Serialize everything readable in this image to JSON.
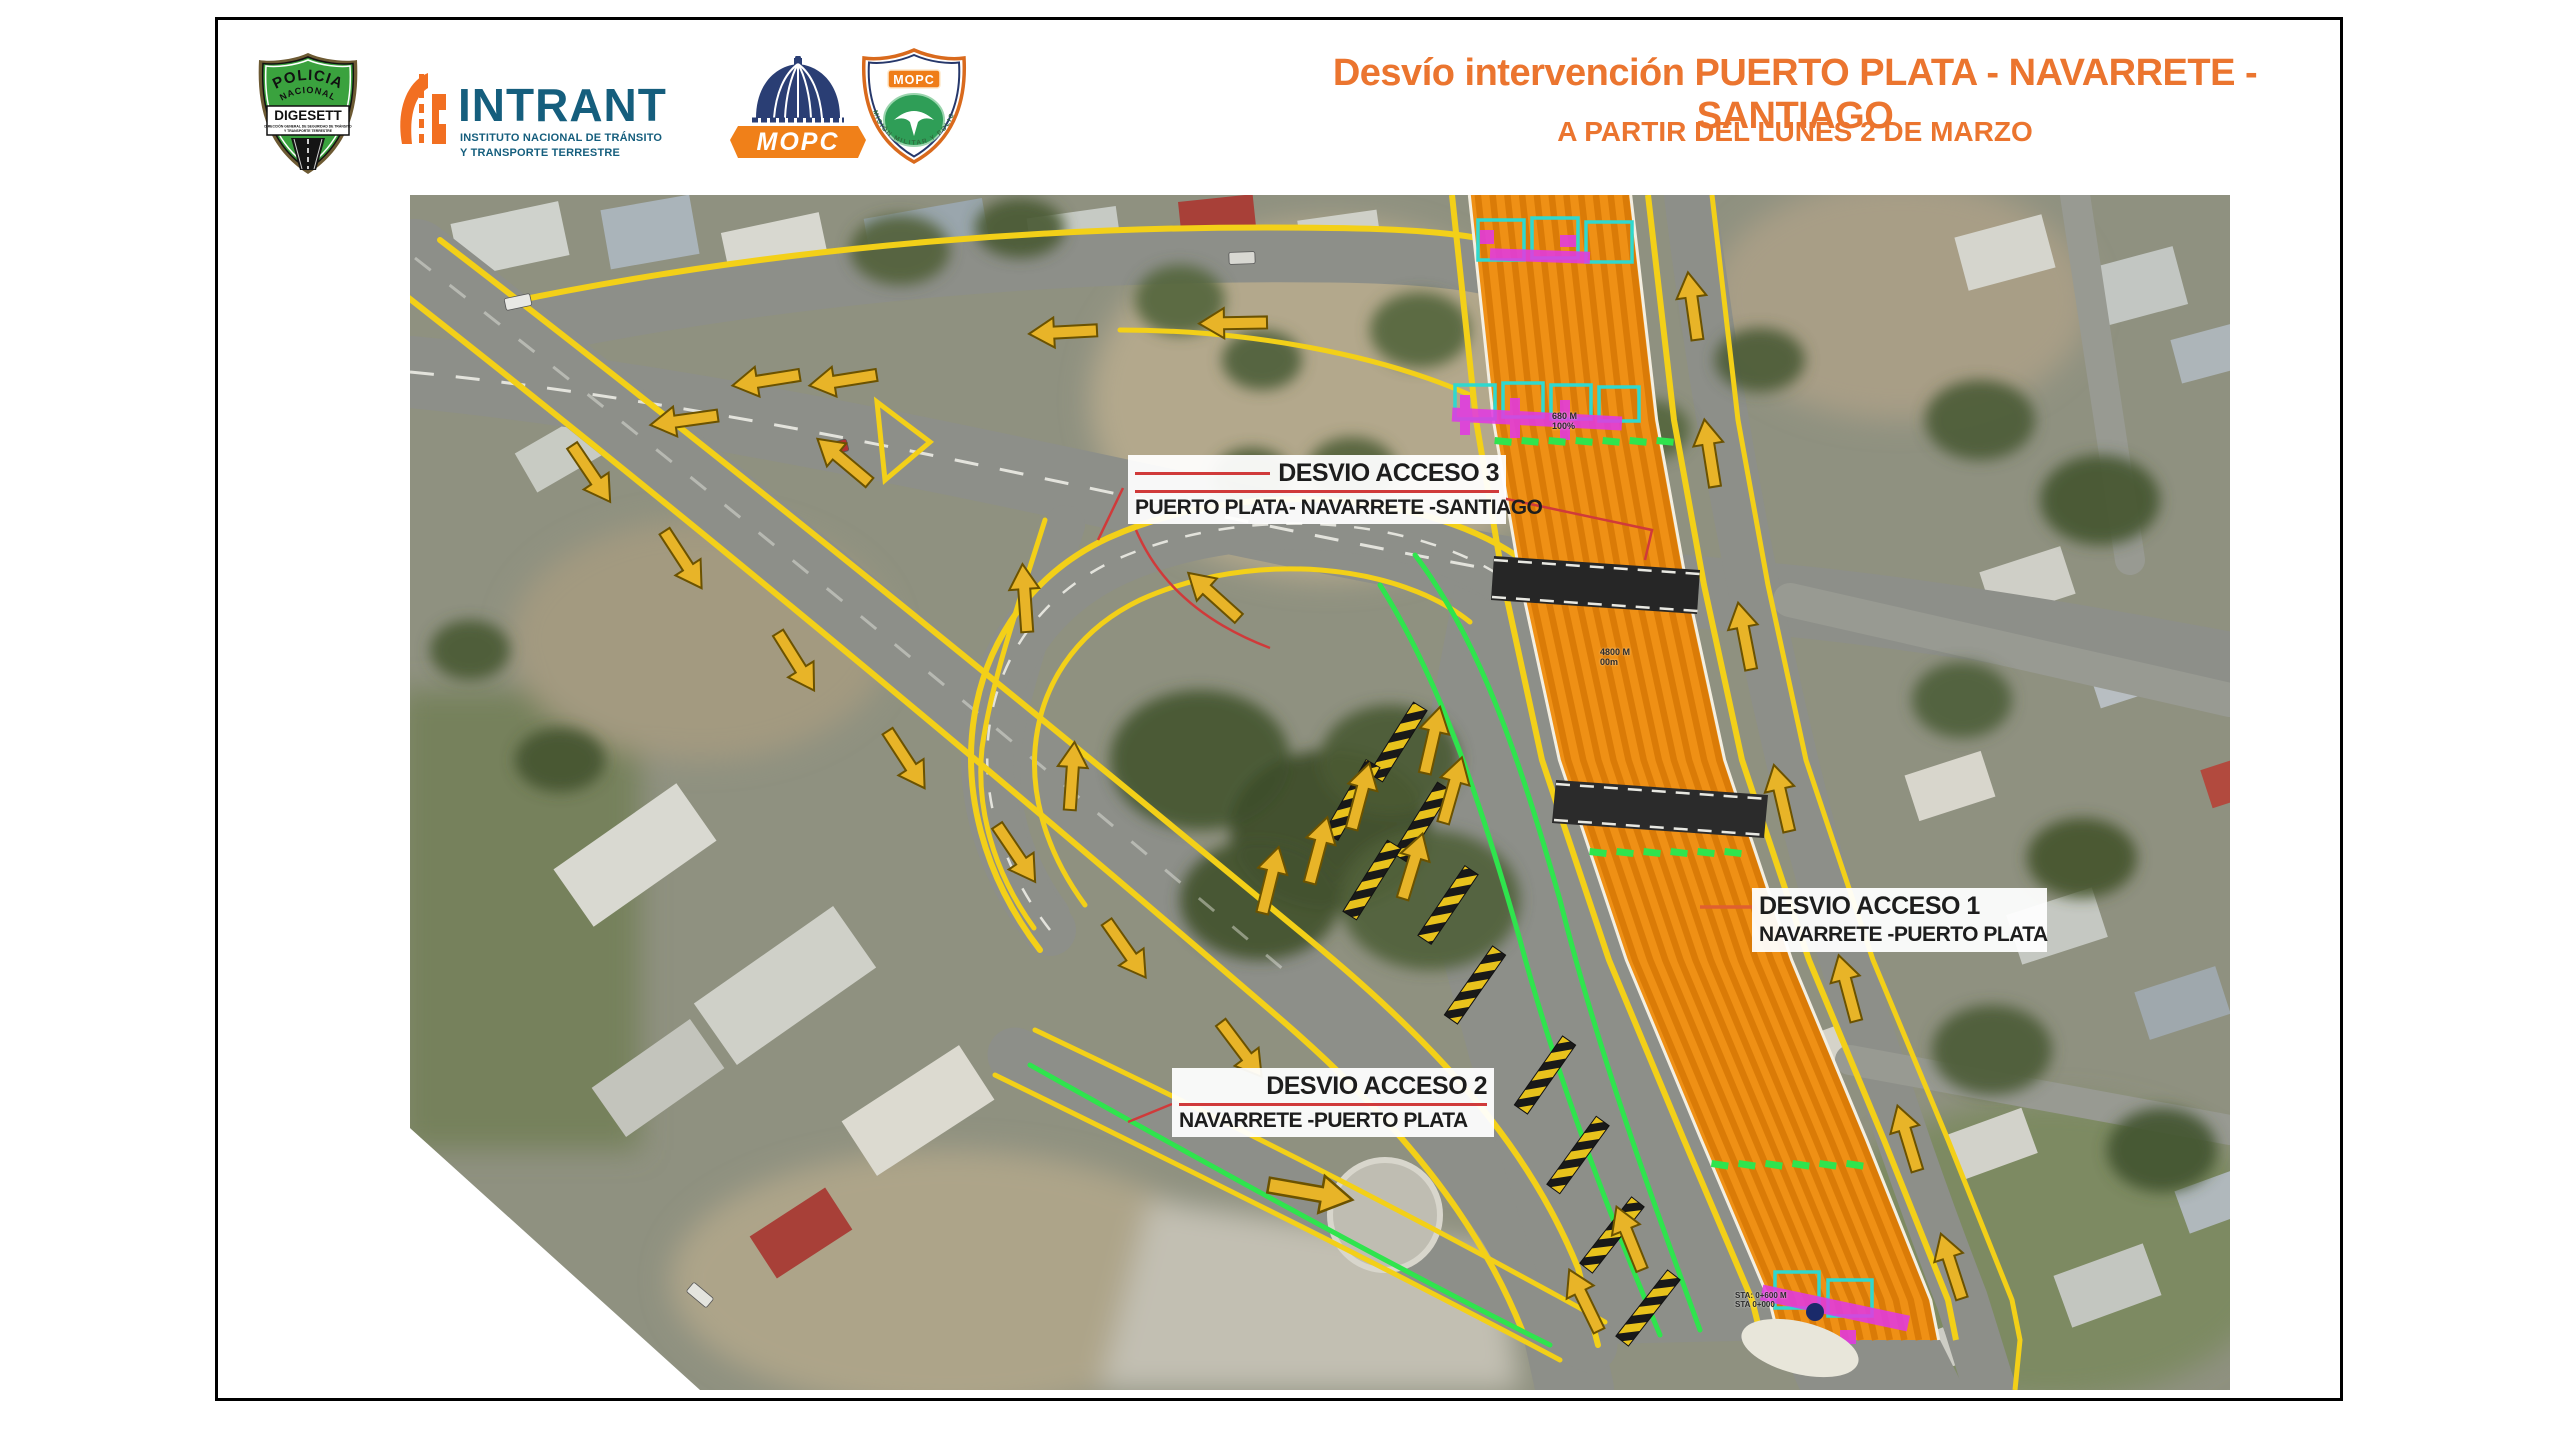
{
  "header": {
    "title": "Desvío intervención PUERTO PLATA - NAVARRETE - SANTIAGO",
    "subtitle": "A PARTIR DEL LUNES 2 DE MARZO",
    "accent_color": "#EB752F",
    "logos": {
      "digesett": {
        "arc_top": "POLICIA",
        "arc_mid": "NACIONAL",
        "band": "DIGESETT",
        "sub1": "DIRECCIÓN GENERAL DE SEGURIDAD DE TRÁNSITO",
        "sub2": "Y TRANSPORTE TERRESTRE"
      },
      "intrant": {
        "name": "INTRANT",
        "tagline1": "INSTITUTO NACIONAL DE TRÁNSITO",
        "tagline2": "Y TRANSPORTE TERRESTRE",
        "brand_color": "#155E7D",
        "icon_color": "#F26F21"
      },
      "mopc": {
        "name": "MOPC",
        "banner_color": "#F08019",
        "dome_color": "#2A3E74"
      },
      "mopc_shield": {
        "name": "MOPC",
        "ring_text": "COMISIÓN MILITAR Y POLICIAL"
      }
    }
  },
  "map": {
    "callouts": [
      {
        "id": "desvio-acceso-3",
        "line1": "DESVIO ACCESO 3",
        "line2": "PUERTO PLATA- NAVARRETE -SANTIAGO"
      },
      {
        "id": "desvio-acceso-1",
        "line1": "DESVIO ACCESO 1",
        "line2": "NAVARRETE -PUERTO PLATA"
      },
      {
        "id": "desvio-acceso-2",
        "line1": "DESVIO ACCESO 2",
        "line2": "NAVARRETE -PUERTO PLATA"
      }
    ],
    "annotations": [
      {
        "id": "station-top",
        "text1": "680 M",
        "text2": "100%"
      },
      {
        "id": "station-mid",
        "text1": "4800 M",
        "text2": "00m"
      },
      {
        "id": "station-bottom",
        "text1": "STA: 0+600 M",
        "text2": "STA 0+000"
      }
    ],
    "colors": {
      "work_zone_orange": "#EF9015",
      "lane_line_yellow": "#F3D018",
      "detour_green": "#2FE44D",
      "barrier_yellow": "#E8C21C",
      "leader_red": "#D03A3A",
      "marker_magenta": "#E23AE2",
      "marker_cyan": "#2FD8CF"
    }
  }
}
